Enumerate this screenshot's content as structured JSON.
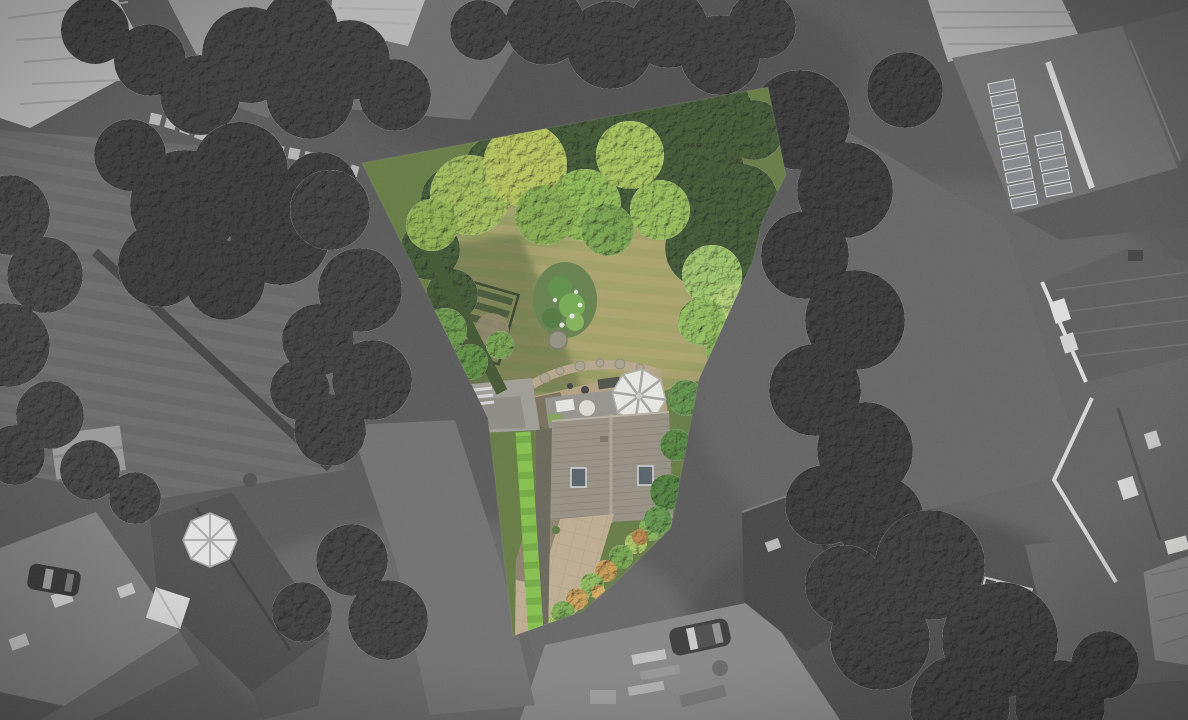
{
  "meta": {
    "description": "Aerial drone photograph of a suburban neighbourhood rendered in greyscale, with a single irregular property plot highlighted in full colour (garden, trees, lawn, house roof, conservatory, patio and hedge).",
    "width": 1188,
    "height": 720
  },
  "highlight": {
    "label": "highlighted-property-plot",
    "points": "362,163 768,87 786,175 762,222 753,260 699,379 671,528 620,578 583,611 513,636 488,418",
    "contents": [
      "garden lawn",
      "mature trees",
      "vegetable patch",
      "island flower bed",
      "stone path",
      "house roof with skylights",
      "white conservatory roof",
      "paved patio",
      "shrub border",
      "bright green hedge",
      "driveway"
    ]
  },
  "background": {
    "style": "greyscale aerial view",
    "features": [
      "neighbouring house roofs",
      "house with rooftop solar panels",
      "large tiled roofs with dormers",
      "dark tree canopies",
      "grey lawns",
      "winding garden path",
      "round patio table set",
      "white conservatory",
      "parked cars",
      "construction yard with materials",
      "garden cold frame"
    ]
  },
  "palette": {
    "bg_base": "#484848",
    "lawn_gray": "#5d5d5d",
    "lawn_gray_stripe": "#565656",
    "roof_light": "#b4b4b4",
    "roof_mid": "#757575",
    "roof_dark": "#303030",
    "tree_gray": "#282828",
    "plot_lawn": "#a09a5c",
    "plot_lawn_stripe": "#8c944e",
    "plot_tree_bright": "#9fc14b",
    "plot_tree_dark": "#2e4a1e",
    "plot_roof": "#91887a",
    "plot_patio": "#bfab8a",
    "conservatory": "#f0f1ec",
    "hedge": "#7cc23a",
    "shrub_orange": "#cf9a44",
    "white_detail": "#e9e9e6"
  }
}
